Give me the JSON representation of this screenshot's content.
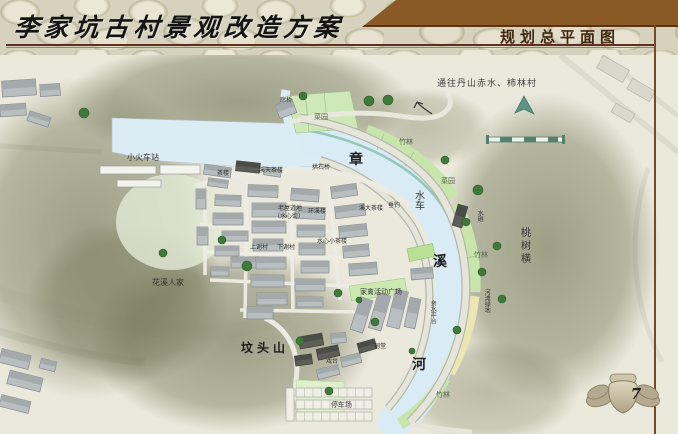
{
  "page": {
    "width": 678,
    "height": 434
  },
  "header": {
    "title": "李家坑古村景观改造方案",
    "section_title": "规划总平面图",
    "colors": {
      "banner_brown": "#8a5a26",
      "rule_maroon": "#5f3020",
      "section_text": "#40280e"
    }
  },
  "map": {
    "river_name": "章溪河",
    "icons": {
      "north_arrow": "north-arrow-icon",
      "scale_bar": "scale-bar",
      "route_arrow": "route-arrow-icon"
    },
    "colors": {
      "water": "#d9ebf4",
      "bank_teal": "#8cc4b4",
      "green_band": "#c8e5ac",
      "sand_band": "#ece6b2",
      "hill_shade": "#6d7150",
      "roof_gray": "#b9bec0",
      "roof_dark": "#5c5e57"
    },
    "labels": [
      {
        "t": "通往丹山赤水、柿林村",
        "x": 437,
        "y": 80,
        "s": 9,
        "c": "#3c3c3c",
        "ls": 1
      },
      {
        "t": "章",
        "x": 349,
        "y": 153,
        "s": 14,
        "b": 1
      },
      {
        "t": "水车",
        "x": 412,
        "y": 190,
        "s": 10,
        "v": 1
      },
      {
        "t": "溪",
        "x": 433,
        "y": 255,
        "s": 14,
        "b": 1
      },
      {
        "t": "河",
        "x": 412,
        "y": 358,
        "s": 14,
        "b": 1
      },
      {
        "t": "桃树横",
        "x": 518,
        "y": 227,
        "s": 10,
        "v": 1,
        "ls": 3
      },
      {
        "t": "竹林",
        "x": 399,
        "y": 139,
        "s": 7,
        "c": "#4c6a46"
      },
      {
        "t": "菜园",
        "x": 314,
        "y": 114,
        "s": 7,
        "c": "#4c6a46"
      },
      {
        "t": "菜园",
        "x": 441,
        "y": 178,
        "s": 7,
        "c": "#4c6a46"
      },
      {
        "t": "竹林",
        "x": 474,
        "y": 252,
        "s": 7,
        "c": "#4c6a46"
      },
      {
        "t": "竹林",
        "x": 436,
        "y": 392,
        "s": 7,
        "c": "#4c6a46"
      },
      {
        "t": "小火车站",
        "x": 127,
        "y": 154,
        "s": 8
      },
      {
        "t": "花溪人家",
        "x": 152,
        "y": 279,
        "s": 8
      },
      {
        "t": "坟头山",
        "x": 241,
        "y": 342,
        "s": 12,
        "ls": 4,
        "b": 1
      },
      {
        "t": "家禽活动广场",
        "x": 360,
        "y": 289,
        "s": 7
      },
      {
        "t": "亲水平台",
        "x": 429,
        "y": 300,
        "s": 6,
        "v": 1
      },
      {
        "t": "河滩绿地",
        "x": 483,
        "y": 289,
        "s": 6,
        "v": 1
      },
      {
        "t": "停车场",
        "x": 331,
        "y": 402,
        "s": 7
      },
      {
        "t": "祠堂",
        "x": 374,
        "y": 344,
        "s": 6
      },
      {
        "t": "戏台",
        "x": 326,
        "y": 359,
        "s": 6
      },
      {
        "t": "茶楼",
        "x": 217,
        "y": 171,
        "s": 6
      },
      {
        "t": "溪天茶楼",
        "x": 259,
        "y": 168,
        "s": 6
      },
      {
        "t": "拱石桥",
        "x": 312,
        "y": 165,
        "s": 6
      },
      {
        "t": "老屋道地",
        "x": 278,
        "y": 206,
        "s": 6
      },
      {
        "t": "（水心街）",
        "x": 274,
        "y": 214,
        "s": 6
      },
      {
        "t": "环溪楼",
        "x": 308,
        "y": 209,
        "s": 6
      },
      {
        "t": "溪大茶楼",
        "x": 359,
        "y": 206,
        "s": 6
      },
      {
        "t": "垂钓",
        "x": 388,
        "y": 203,
        "s": 6
      },
      {
        "t": "水心小茶楼",
        "x": 317,
        "y": 239,
        "s": 6
      },
      {
        "t": "上谢村",
        "x": 250,
        "y": 245,
        "s": 6
      },
      {
        "t": "下谢村",
        "x": 277,
        "y": 245,
        "s": 6
      },
      {
        "t": "廊桥",
        "x": 280,
        "y": 98,
        "s": 6
      },
      {
        "t": "水碓",
        "x": 476,
        "y": 210,
        "s": 6,
        "v": 1
      }
    ]
  },
  "footer": {
    "page_number": "7"
  }
}
